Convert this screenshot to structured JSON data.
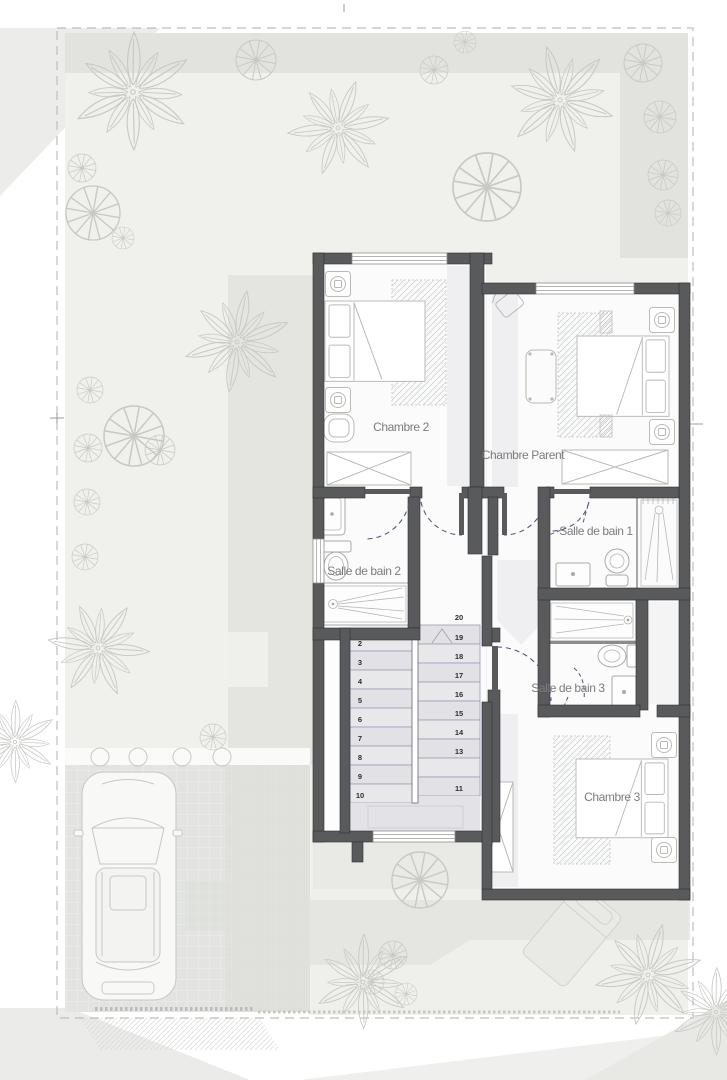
{
  "plan": {
    "type": "architectural-floor-plan-upper-storey",
    "floor_labels": {
      "chambre2": "Chambre 2",
      "chambre_parent": "Chambre Parent",
      "chambre3": "Chambre 3",
      "sdb1": "Salle de bain 1",
      "sdb2": "Salle de bain 2",
      "sdb3": "Salle de bain 3"
    },
    "stairs": {
      "left": [
        "2",
        "3",
        "4",
        "5",
        "6",
        "7",
        "8",
        "9",
        "10"
      ],
      "right": [
        "20",
        "19",
        "18",
        "17",
        "16",
        "15",
        "14",
        "13",
        "11"
      ]
    },
    "colors": {
      "wall": "#595a5c",
      "garden": "#f0f0ed",
      "garden_shade": "#e2e3de",
      "driveway": "#e3e4e1",
      "stair_line": "#9b9bb5",
      "door_arc": "#565678",
      "label_text": "#7b7c7e",
      "furniture_line": "#b9bab6"
    },
    "icons": [
      "palm-tree-icon",
      "round-tree-icon",
      "car-top-icon",
      "double-bed-icon",
      "nightstand-lamp-icon",
      "wardrobe-icon",
      "rug",
      "armchair-icon",
      "desk-chair-icon",
      "bench-icon",
      "sink-icon",
      "toilet-icon",
      "shower-icon",
      "vanity-icon",
      "staircase",
      "door-swing",
      "window",
      "lounge-chair-icon"
    ]
  }
}
